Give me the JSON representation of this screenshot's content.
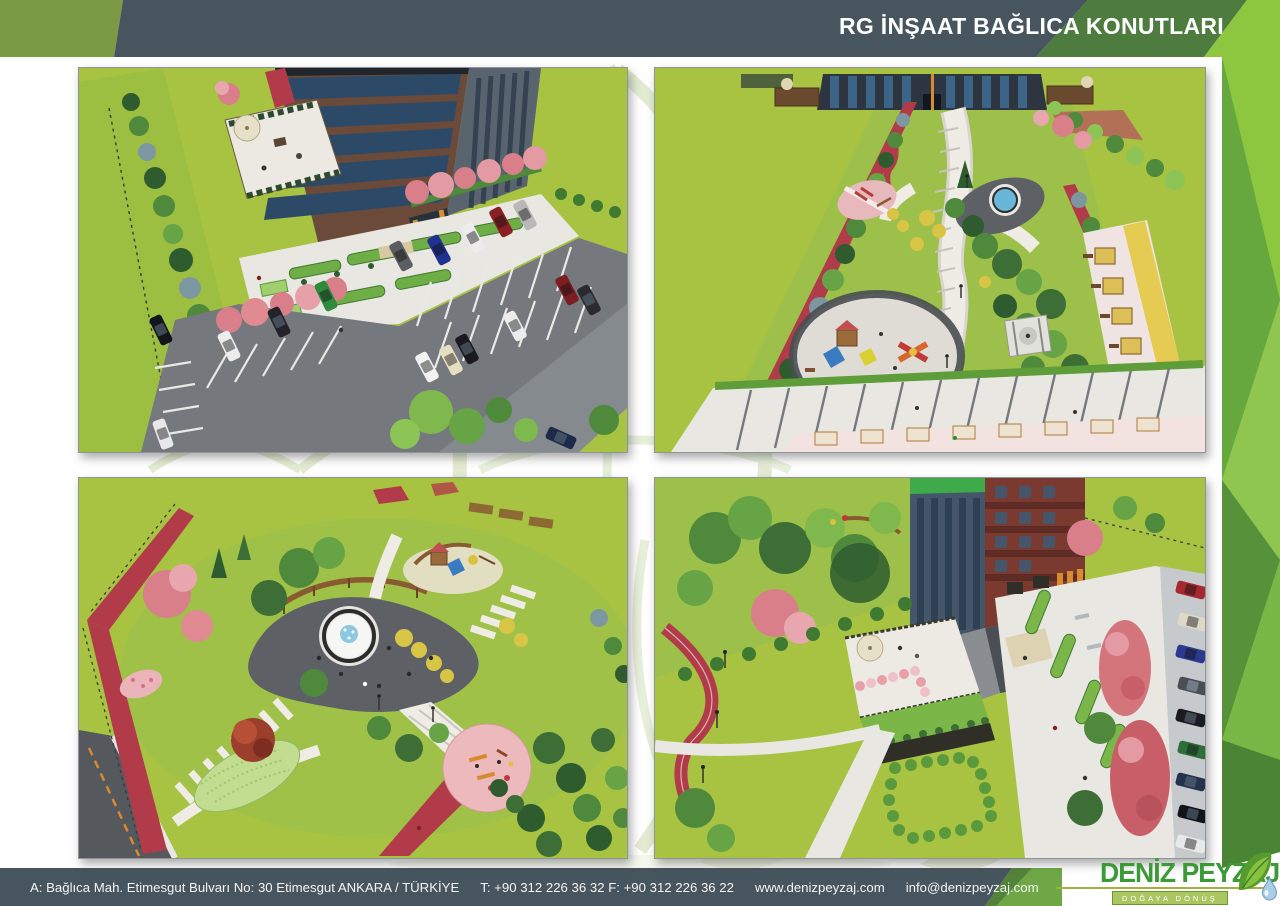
{
  "header": {
    "title": "RG İNŞAAT BAĞLICA KONUTLARI"
  },
  "gallery": {
    "images": [
      {
        "id": "top-left",
        "description": "Aerial 3D render of an apartment block with landscaped forecourt, flowering pink trees and a car park full of parked cars"
      },
      {
        "id": "top-right",
        "description": "Aerial 3D render of a linear park with winding path, round fountain, children playground, yellow picnic pergolas and parking rows"
      },
      {
        "id": "bottom-left",
        "description": "Aerial 3D render of a park with circular fountain plaza, red jogging track, outdoor fitness circle and striped walkways"
      },
      {
        "id": "bottom-right",
        "description": "Aerial 3D render of a residential tower with roof terrace, hedged promenade, red autumn trees and street parking"
      }
    ]
  },
  "footer": {
    "address_label": "A: Bağlıca Mah.  Etimesgut  Bulvarı  No: 30 Etimesgut ANKARA / TÜRKİYE",
    "phone_label": "T: +90 312 226 36 32 F: +90 312 226 36 22",
    "website": "www.denizpeyzaj.com",
    "email": "info@denizpeyzaj.com"
  },
  "logo": {
    "name": "DENİZ PEYZAJ",
    "tagline": "DOĞAYA DÖNÜŞ"
  },
  "colors": {
    "header_bar": "#46555e",
    "accent_olive": "#7b9a44",
    "accent_green_dark": "#4d7c3e",
    "accent_green_light": "#8dc63f",
    "logo_green": "#3a9a35",
    "track_red": "#b13b49",
    "lawn_green": "#a8c342"
  }
}
